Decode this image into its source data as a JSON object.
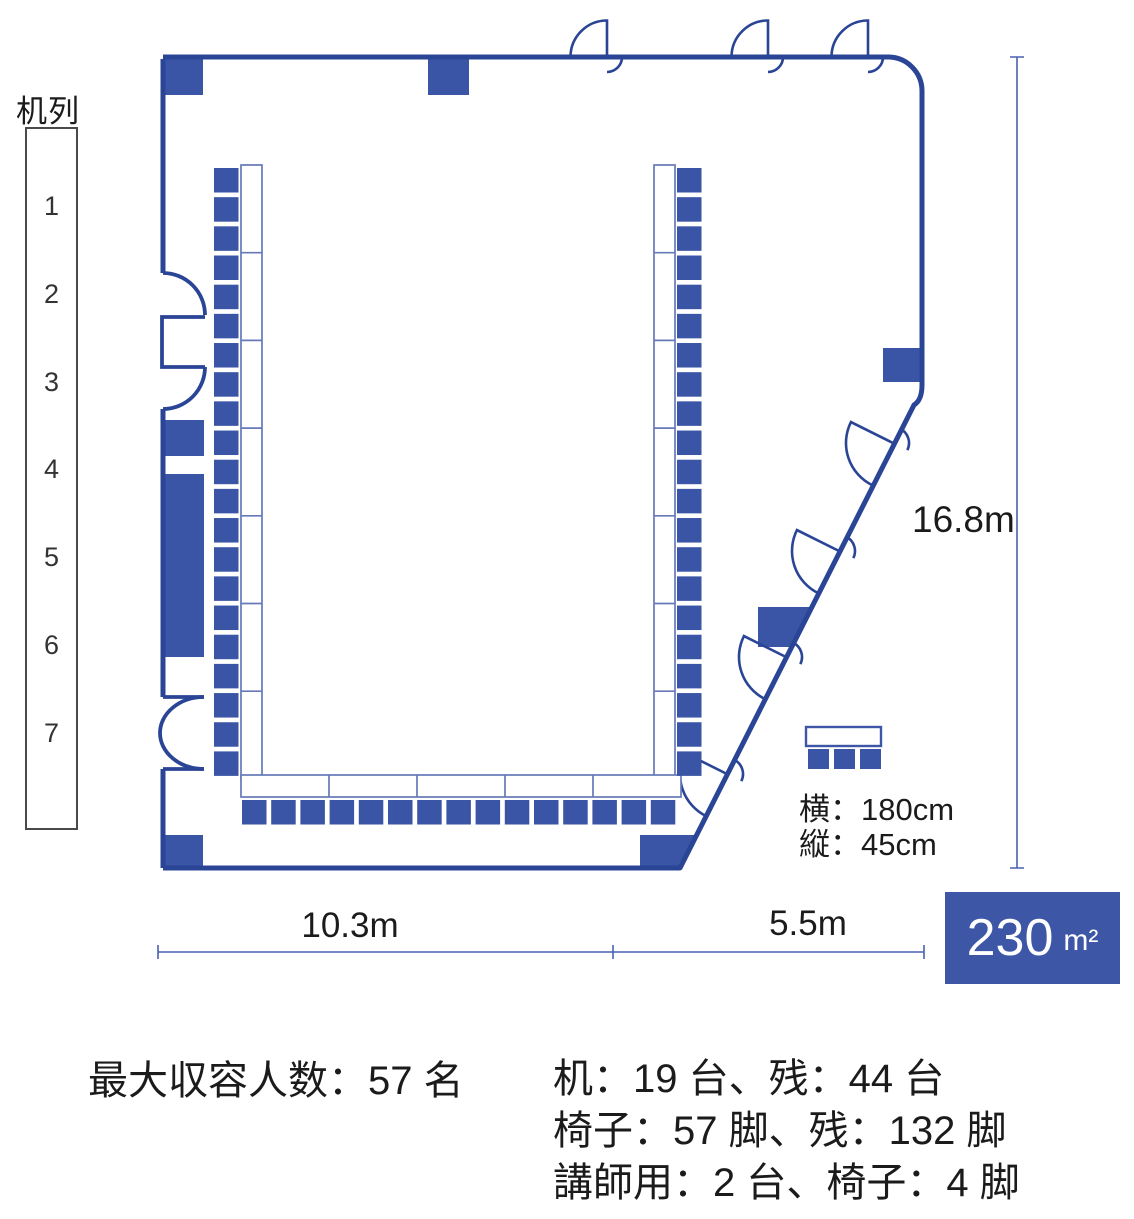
{
  "legend": {
    "title": "机列",
    "rows": [
      "1",
      "2",
      "3",
      "4",
      "5",
      "6",
      "7"
    ]
  },
  "dimensions": {
    "height": "16.8m",
    "width_left": "10.3m",
    "width_right": "5.5m"
  },
  "desk_spec": {
    "width": "横：180cm",
    "depth": "縦：45cm"
  },
  "area": {
    "value": "230",
    "unit": "m²"
  },
  "capacity": {
    "max": "最大収容人数：57 名"
  },
  "inventory": {
    "desks": "机：19 台、残：44 台",
    "chairs": "椅子：57 脚、残：132 脚",
    "lecturer": "講師用：2 台、椅子：4 脚"
  },
  "floorplan": {
    "left_column": {
      "desks": 7,
      "chairs": 21
    },
    "right_column": {
      "desks": 7,
      "chairs": 21
    },
    "bottom_row": {
      "desks": 5,
      "chairs": 15
    },
    "legend_sample_chairs": 3,
    "colors": {
      "furniture": "#3A55A5",
      "wall": "#2B4596",
      "desk_border": "#6679B8",
      "dimension_line": "#4962B3",
      "badge": "#3D56A6"
    }
  }
}
